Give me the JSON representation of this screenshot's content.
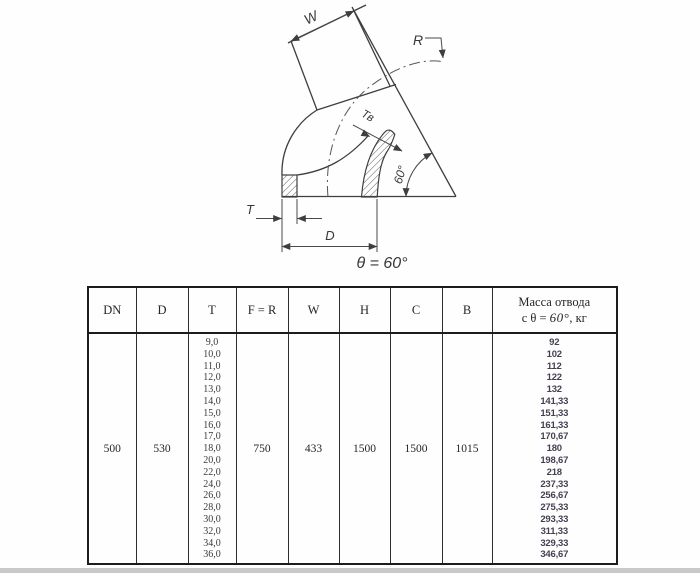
{
  "drawing": {
    "labels": {
      "w": "W",
      "r": "R",
      "t_inner": "Тв",
      "angle": "60°",
      "t": "T",
      "d": "D",
      "theta": "θ = 60°"
    }
  },
  "table": {
    "headers": [
      "DN",
      "D",
      "T",
      "F = R",
      "W",
      "H",
      "C",
      "B"
    ],
    "mass_header": {
      "line1": "Масса отвода",
      "line2_prefix": "с θ = ",
      "line2_value": "60°",
      "line2_suffix": ", кг"
    },
    "row": {
      "dn": "500",
      "d": "530",
      "f_r": "750",
      "w": "433",
      "h": "1500",
      "c": "1500",
      "b": "1015",
      "t_values": [
        "9,0",
        "10,0",
        "11,0",
        "12,0",
        "13,0",
        "14,0",
        "15,0",
        "16,0",
        "17,0",
        "18,0",
        "20,0",
        "22,0",
        "24,0",
        "26,0",
        "28,0",
        "30,0",
        "32,0",
        "34,0",
        "36,0"
      ],
      "mass_values": [
        "92",
        "102",
        "112",
        "122",
        "132",
        "141,33",
        "151,33",
        "161,33",
        "170,67",
        "180",
        "198,67",
        "218",
        "237,33",
        "256,67",
        "275,33",
        "293,33",
        "311,33",
        "329,33",
        "346,67"
      ]
    }
  }
}
